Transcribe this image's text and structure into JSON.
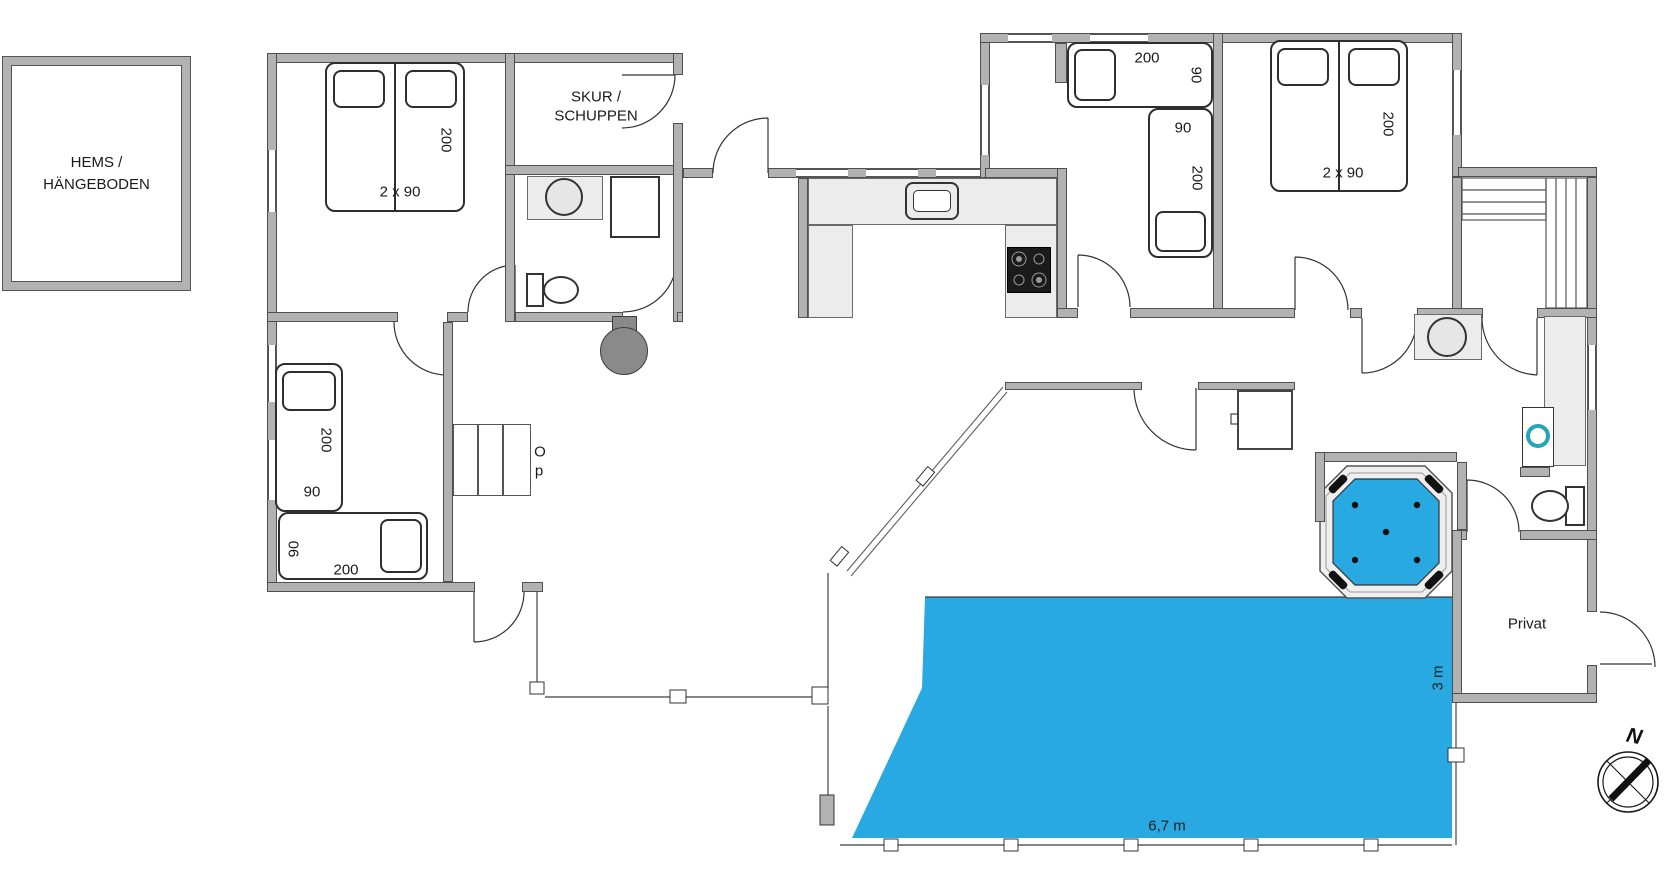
{
  "labels": {
    "hems_line1": "HEMS /",
    "hems_line2": "HÄNGEBODEN",
    "skur_line1": "SKUR /",
    "skur_line2": "SCHUPPEN",
    "privat": "Privat",
    "stairs_up_o": "O",
    "stairs_up_p": "p",
    "pool_width": "6,7 m",
    "pool_depth": "3 m",
    "compass_north": "N"
  },
  "beds": {
    "tl_double": {
      "length": "200",
      "width": "2 x 90"
    },
    "bl_single_1": {
      "length": "200",
      "width": "90"
    },
    "bl_single_2": {
      "length": "200",
      "width": "90"
    },
    "tr_single_1": {
      "length": "200",
      "width": "90"
    },
    "tr_single_2": {
      "length": "200",
      "width": "90"
    },
    "tr_double": {
      "length": "200",
      "width": "2 x 90"
    }
  },
  "colors": {
    "pool_blue": "#29a9e1",
    "wall_gray": "#b2b2b2",
    "counter_gray": "#ececec",
    "washer_ring_teal": "#25a5b8"
  }
}
